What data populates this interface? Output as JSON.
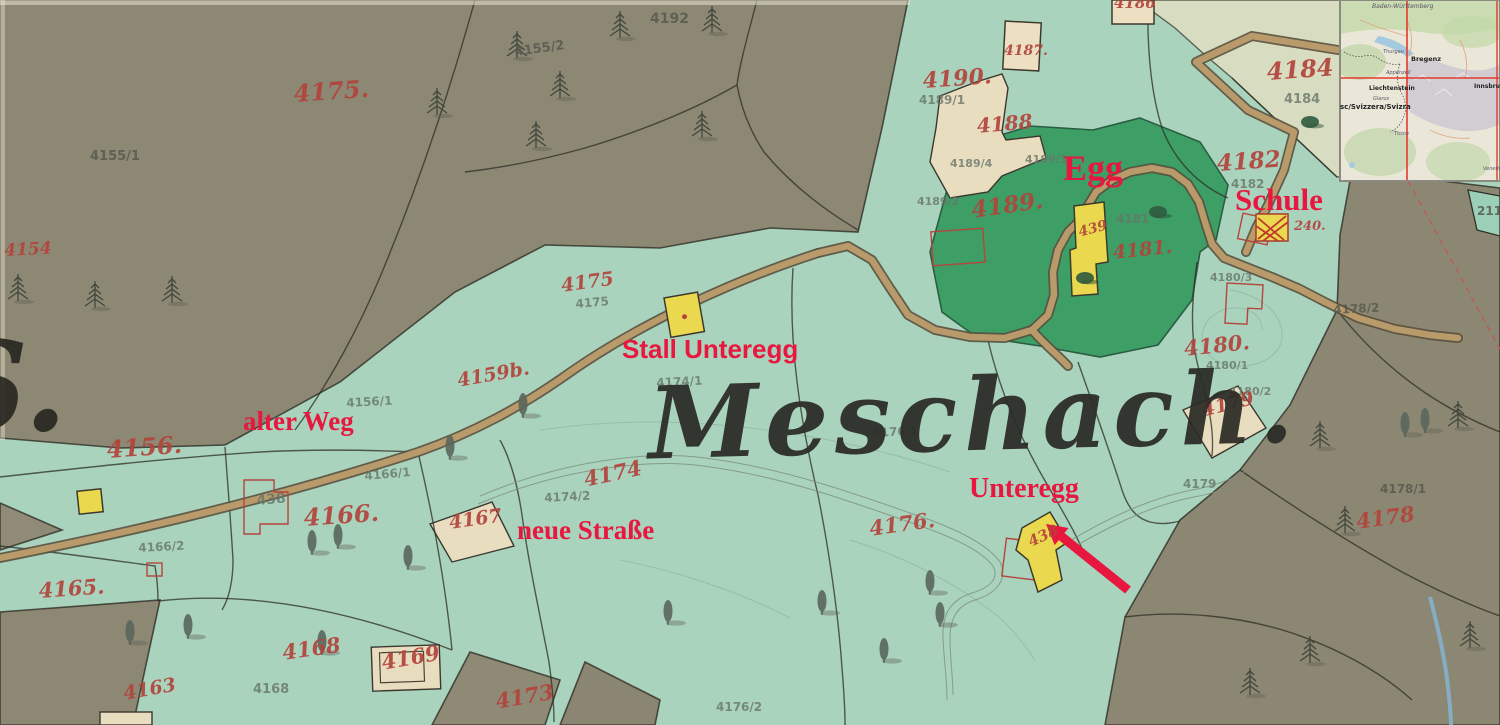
{
  "map": {
    "title": "Meschach.",
    "edge_letter": {
      "text": "S.",
      "x": -62,
      "y": 314,
      "size": 125
    },
    "annotations": [
      {
        "id": "egg",
        "text": "Egg",
        "x": 1063,
        "y": 150,
        "size": 36,
        "font": "serif"
      },
      {
        "id": "schule",
        "text": "Schule",
        "x": 1235,
        "y": 184,
        "size": 31,
        "font": "serif"
      },
      {
        "id": "stall-unteregg",
        "text": "Stall Unteregg",
        "x": 622,
        "y": 336,
        "size": 26,
        "font": "sans"
      },
      {
        "id": "alter-weg",
        "text": "alter Weg",
        "x": 243,
        "y": 408,
        "size": 27,
        "font": "serif"
      },
      {
        "id": "neue-strasse",
        "text": "neue Straße",
        "x": 517,
        "y": 517,
        "size": 27,
        "font": "serif"
      },
      {
        "id": "unteregg",
        "text": "Unteregg",
        "x": 969,
        "y": 475,
        "size": 28,
        "font": "serif"
      }
    ],
    "arrow": {
      "tail_x": 1128,
      "tail_y": 590,
      "head_x": 1046,
      "head_y": 524,
      "color": "#e8173f"
    },
    "parcel_numbers": [
      {
        "t": "4175.",
        "x": 293,
        "y": 82,
        "s": 24,
        "c": "r",
        "r": -4
      },
      {
        "t": "4155/2",
        "x": 514,
        "y": 46,
        "s": 13,
        "c": "d",
        "r": -8
      },
      {
        "t": "4192",
        "x": 650,
        "y": 12,
        "s": 14,
        "c": "d",
        "r": 0
      },
      {
        "t": "4155/1",
        "x": 90,
        "y": 150,
        "s": 13,
        "c": "d",
        "r": 0
      },
      {
        "t": "4154",
        "x": 4,
        "y": 243,
        "s": 17,
        "c": "r",
        "r": -3
      },
      {
        "t": "4156.",
        "x": 106,
        "y": 438,
        "s": 24,
        "c": "r",
        "r": -4
      },
      {
        "t": "4156/1",
        "x": 346,
        "y": 397,
        "s": 12,
        "c": "g",
        "r": -3
      },
      {
        "t": "4159b.",
        "x": 456,
        "y": 372,
        "s": 19,
        "c": "r",
        "r": -10
      },
      {
        "t": "4175",
        "x": 560,
        "y": 277,
        "s": 19,
        "c": "r",
        "r": -8
      },
      {
        "t": "4175",
        "x": 575,
        "y": 298,
        "s": 12,
        "c": "g",
        "r": -5
      },
      {
        "t": "4166.",
        "x": 303,
        "y": 506,
        "s": 24,
        "c": "r",
        "r": -4
      },
      {
        "t": "4166/1",
        "x": 364,
        "y": 470,
        "s": 12,
        "c": "g",
        "r": -5
      },
      {
        "t": "4166/2",
        "x": 138,
        "y": 542,
        "s": 12,
        "c": "g",
        "r": -3
      },
      {
        "t": "4165.",
        "x": 38,
        "y": 580,
        "s": 21,
        "c": "r",
        "r": -4
      },
      {
        "t": "4167",
        "x": 448,
        "y": 514,
        "s": 19,
        "c": "r",
        "r": -8
      },
      {
        "t": "4174/2",
        "x": 544,
        "y": 492,
        "s": 12,
        "c": "g",
        "r": -3
      },
      {
        "t": "4174",
        "x": 582,
        "y": 469,
        "s": 21,
        "c": "r",
        "r": -12
      },
      {
        "t": "4168",
        "x": 281,
        "y": 642,
        "s": 21,
        "c": "r",
        "r": -8
      },
      {
        "t": "4168",
        "x": 253,
        "y": 683,
        "s": 13,
        "c": "g",
        "r": 0
      },
      {
        "t": "4169",
        "x": 380,
        "y": 652,
        "s": 21,
        "c": "r",
        "r": -10
      },
      {
        "t": "4163",
        "x": 122,
        "y": 685,
        "s": 19,
        "c": "r",
        "r": -10
      },
      {
        "t": "4173",
        "x": 494,
        "y": 691,
        "s": 21,
        "c": "r",
        "r": -10
      },
      {
        "t": "4176/2",
        "x": 716,
        "y": 701,
        "s": 12,
        "c": "g",
        "r": 0
      },
      {
        "t": "4174/1",
        "x": 656,
        "y": 377,
        "s": 12,
        "c": "g",
        "r": -3
      },
      {
        "t": "4176/1",
        "x": 872,
        "y": 427,
        "s": 12,
        "c": "g",
        "r": -3
      },
      {
        "t": "4176.",
        "x": 868,
        "y": 518,
        "s": 21,
        "c": "r",
        "r": -8
      },
      {
        "t": "4190.",
        "x": 922,
        "y": 70,
        "s": 22,
        "c": "r",
        "r": -4
      },
      {
        "t": "4189/1",
        "x": 919,
        "y": 94,
        "s": 12,
        "c": "g",
        "r": 0
      },
      {
        "t": "4188",
        "x": 976,
        "y": 116,
        "s": 20,
        "c": "r",
        "r": -5
      },
      {
        "t": "4187.",
        "x": 1004,
        "y": 44,
        "s": 14,
        "c": "r",
        "r": 0
      },
      {
        "t": "4186",
        "x": 1114,
        "y": -4,
        "s": 15,
        "c": "r",
        "r": 0
      },
      {
        "t": "4189/4",
        "x": 950,
        "y": 158,
        "s": 11,
        "c": "g",
        "r": 0
      },
      {
        "t": "4189/3",
        "x": 1025,
        "y": 154,
        "s": 11,
        "c": "g",
        "r": 0
      },
      {
        "t": "4189/2",
        "x": 917,
        "y": 196,
        "s": 11,
        "c": "g",
        "r": 0
      },
      {
        "t": "4189.",
        "x": 970,
        "y": 199,
        "s": 23,
        "c": "r",
        "r": -8
      },
      {
        "t": "4181",
        "x": 1116,
        "y": 213,
        "s": 12,
        "c": "g",
        "r": 0
      },
      {
        "t": "4181.",
        "x": 1112,
        "y": 244,
        "s": 19,
        "c": "r",
        "r": -6
      },
      {
        "t": "4184",
        "x": 1266,
        "y": 60,
        "s": 24,
        "c": "r",
        "r": -4
      },
      {
        "t": "4184",
        "x": 1284,
        "y": 93,
        "s": 13,
        "c": "g",
        "r": 0
      },
      {
        "t": "4182",
        "x": 1216,
        "y": 152,
        "s": 23,
        "c": "r",
        "r": -4
      },
      {
        "t": "4182",
        "x": 1231,
        "y": 178,
        "s": 12,
        "c": "g",
        "r": 0
      },
      {
        "t": "4180/3",
        "x": 1210,
        "y": 272,
        "s": 11,
        "c": "g",
        "r": 0
      },
      {
        "t": "4180.",
        "x": 1183,
        "y": 338,
        "s": 21,
        "c": "r",
        "r": -6
      },
      {
        "t": "4180/1",
        "x": 1206,
        "y": 360,
        "s": 11,
        "c": "g",
        "r": 0
      },
      {
        "t": "4180/2",
        "x": 1229,
        "y": 386,
        "s": 11,
        "c": "g",
        "r": 0
      },
      {
        "t": "4179",
        "x": 1200,
        "y": 402,
        "s": 19,
        "c": "r",
        "r": -14
      },
      {
        "t": "4179",
        "x": 1183,
        "y": 478,
        "s": 12,
        "c": "g",
        "r": 0
      },
      {
        "t": "4178/2",
        "x": 1333,
        "y": 304,
        "s": 12,
        "c": "d",
        "r": -3
      },
      {
        "t": "4178/1",
        "x": 1380,
        "y": 483,
        "s": 12,
        "c": "d",
        "r": 0
      },
      {
        "t": "4178",
        "x": 1355,
        "y": 511,
        "s": 21,
        "c": "r",
        "r": -8
      },
      {
        "t": "211",
        "x": 1477,
        "y": 205,
        "s": 12,
        "c": "d",
        "r": 0
      },
      {
        "t": "438",
        "x": 256,
        "y": 494,
        "s": 14,
        "c": "g",
        "r": -5
      }
    ],
    "building_numbers": [
      {
        "t": "438",
        "x": 1026,
        "y": 536,
        "s": 15,
        "r": -25
      },
      {
        "t": "439",
        "x": 1077,
        "y": 226,
        "s": 14,
        "r": -15
      },
      {
        "t": "240.",
        "x": 1294,
        "y": 220,
        "s": 13,
        "r": 0
      }
    ],
    "trees": {
      "conifers": [
        [
          517,
          55
        ],
        [
          620,
          35
        ],
        [
          702,
          135
        ],
        [
          536,
          145
        ],
        [
          437,
          112
        ],
        [
          712,
          30
        ],
        [
          560,
          95
        ],
        [
          95,
          305
        ],
        [
          18,
          298
        ],
        [
          172,
          300
        ],
        [
          1320,
          445
        ],
        [
          1458,
          425
        ],
        [
          1345,
          530
        ],
        [
          1250,
          692
        ],
        [
          1310,
          660
        ],
        [
          1470,
          645
        ]
      ],
      "broadleaf": [
        [
          450,
          455
        ],
        [
          523,
          413
        ],
        [
          408,
          565
        ],
        [
          312,
          550
        ],
        [
          338,
          544
        ],
        [
          130,
          640
        ],
        [
          188,
          634
        ],
        [
          322,
          650
        ],
        [
          668,
          620
        ],
        [
          822,
          610
        ],
        [
          930,
          590
        ],
        [
          940,
          622
        ],
        [
          884,
          658
        ],
        [
          1405,
          432
        ],
        [
          1425,
          428
        ]
      ],
      "groves": [
        [
          1085,
          278
        ],
        [
          1158,
          212
        ],
        [
          1310,
          122
        ]
      ]
    }
  },
  "inset_map": {
    "crosshair_color": "#e23b2a",
    "labels": [
      {
        "text": "Baden-Württemberg",
        "x": 1372,
        "y": 4,
        "s": 6,
        "cls": "it"
      },
      {
        "text": "Thurgau",
        "x": 1383,
        "y": 50,
        "s": 5,
        "cls": "it"
      },
      {
        "text": "Bregenz",
        "x": 1411,
        "y": 56,
        "s": 6.5,
        "cls": "b"
      },
      {
        "text": "Appenzell",
        "x": 1386,
        "y": 71,
        "s": 5,
        "cls": "it"
      },
      {
        "text": "Liechtenstein",
        "x": 1369,
        "y": 86,
        "s": 6,
        "cls": "b"
      },
      {
        "text": "Glarus",
        "x": 1373,
        "y": 97,
        "s": 5,
        "cls": "it"
      },
      {
        "text": "sc/Svizzera/Svizra",
        "x": 1340,
        "y": 104,
        "s": 7,
        "cls": "b"
      },
      {
        "text": "Innsbruck",
        "x": 1474,
        "y": 84,
        "s": 6,
        "cls": "b"
      },
      {
        "text": "Ticino",
        "x": 1394,
        "y": 132,
        "s": 5,
        "cls": "it"
      },
      {
        "text": "Venetien",
        "x": 1483,
        "y": 167,
        "s": 5,
        "cls": "it"
      }
    ]
  },
  "colors": {
    "mint": "#a9d3bd",
    "olive": "#8d8874",
    "pale_field": "#d8dcc0",
    "dark_green": "#3d9e66",
    "tan_parcel": "#e9ddc0",
    "yellow_building": "#ead94f",
    "road_fill": "#b99a6b",
    "annotation_red": "#e8173f",
    "hand_number_red": "#b2443c",
    "survey_gray": "#68766a",
    "ink": "#2b2b26",
    "stream_blue": "#86b4d4"
  }
}
